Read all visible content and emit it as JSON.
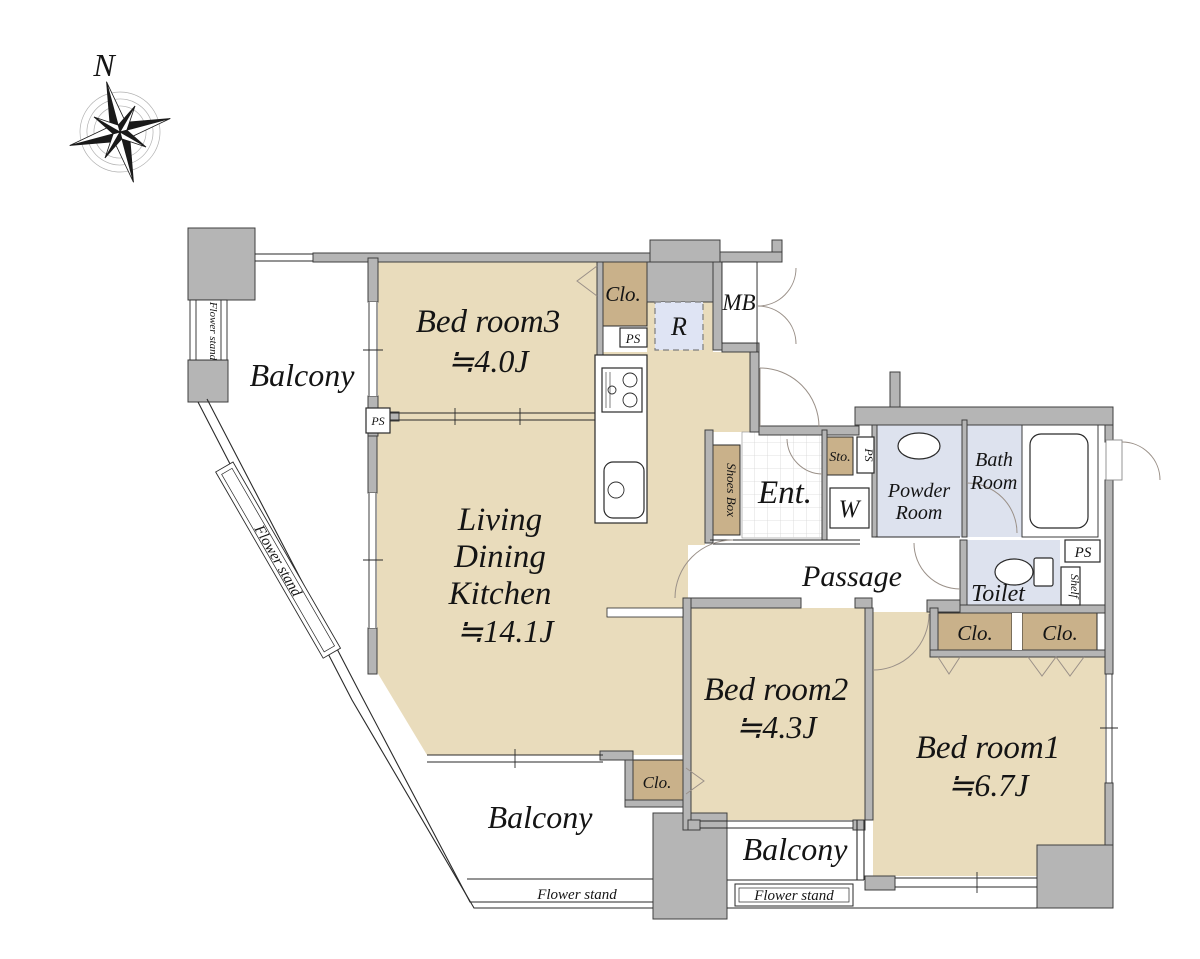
{
  "compass": {
    "north": "N"
  },
  "rooms": {
    "bedroom3": {
      "name": "Bed room3",
      "area": "≒4.0J"
    },
    "living_dining_kitchen": {
      "line1": "Living",
      "line2": "Dining",
      "line3": "Kitchen",
      "area": "≒14.1J"
    },
    "bedroom2": {
      "name": "Bed room2",
      "area": "≒4.3J"
    },
    "bedroom1": {
      "name": "Bed room1",
      "area": "≒6.7J"
    },
    "entrance": {
      "name": "Ent."
    },
    "passage": {
      "name": "Passage"
    },
    "powder_room": {
      "line1": "Powder",
      "line2": "Room"
    },
    "bath_room": {
      "line1": "Bath",
      "line2": "Room"
    },
    "toilet": {
      "name": "Toilet"
    }
  },
  "labels": {
    "balcony": "Balcony",
    "flower_stand": "Flower stand",
    "closet": "Clo.",
    "pipe_space": "PS",
    "meter_box": "MB",
    "refrigerator": "R",
    "washing_machine": "W",
    "storage": "Sto.",
    "shoes_box": "Shoes Box",
    "shelf": "Shelf"
  },
  "colors": {
    "room_fill": "#e9dcbc",
    "closet_fill": "#c9b18a",
    "wet_area_fill": "#dde2ee",
    "refrigerator_fill": "#dfe4f4",
    "wall_fill": "#b5b5b5"
  }
}
